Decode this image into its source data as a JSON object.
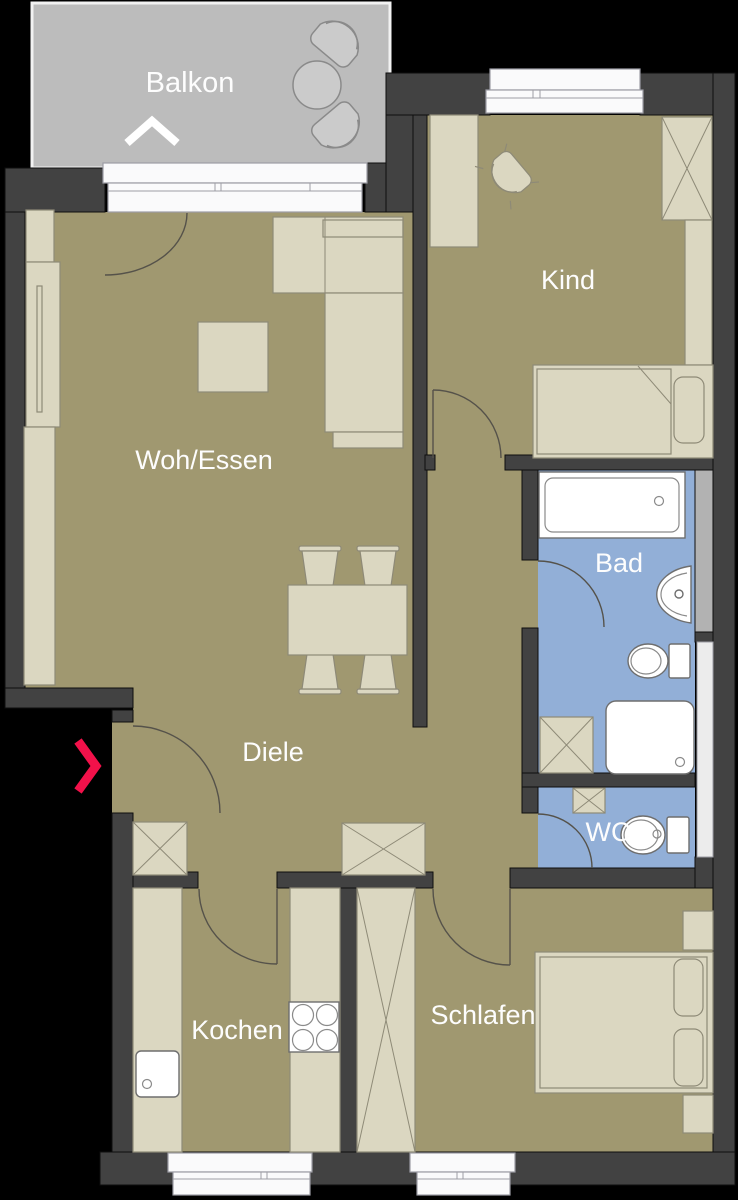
{
  "page": {
    "title": "Wohnung Grundriss",
    "type": "floor-plan"
  },
  "colors": {
    "outside": "#000000",
    "wall": "#424242",
    "floor": "#a09870",
    "bath_floor": "#92afd7",
    "balcony_floor": "#bcbcbc",
    "furniture": "#dbd7c1",
    "fixture_white": "#ffffff",
    "window_white": "#fafafb",
    "shaft_gray": "#b2b2b2",
    "shaft_light": "#ececec",
    "accent_red": "#f2114a",
    "label_text": "#fdfdfd"
  },
  "rooms": {
    "balkon": {
      "label": "Balkon"
    },
    "woh_essen": {
      "label": "Woh/Essen"
    },
    "kind": {
      "label": "Kind"
    },
    "bad": {
      "label": "Bad"
    },
    "wc": {
      "label": "WC"
    },
    "diele": {
      "label": "Diele"
    },
    "kochen": {
      "label": "Kochen"
    },
    "schlafen": {
      "label": "Schlafen"
    }
  },
  "icons": {
    "entrance_arrow": "chevron-right",
    "balcony_marker": "chevron-up"
  }
}
